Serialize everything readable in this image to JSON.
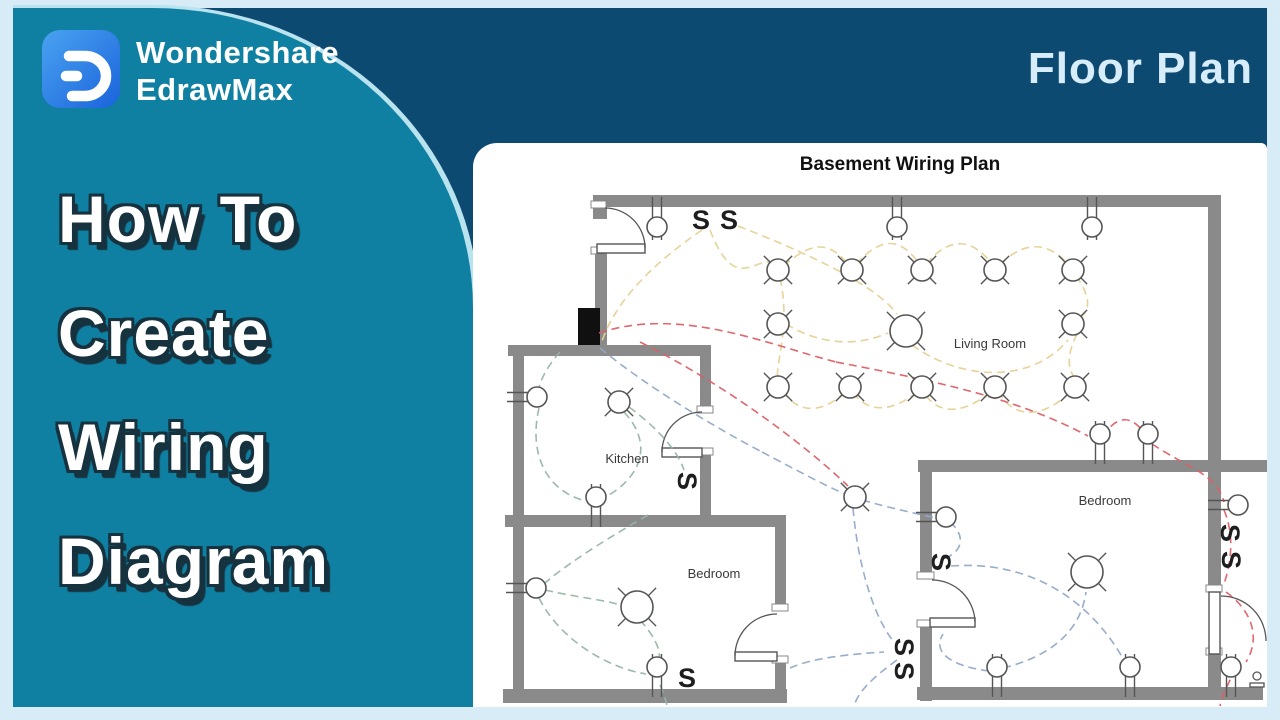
{
  "brand": {
    "line1": "Wondershare",
    "line2": "EdrawMax"
  },
  "badge": "Floor Plan",
  "headline": {
    "lines": [
      "How To",
      "Create",
      "Wiring",
      "Diagram"
    ]
  },
  "colors": {
    "frame": "#d7ecf7",
    "navy": "#0d4a72",
    "teal": "#1080a2",
    "badge_text": "#d7edfa",
    "headline_fill": "#ffffff",
    "headline_outline": "#16323f",
    "logo_from": "#4aa3f0",
    "logo_to": "#1a63dc"
  },
  "plan": {
    "title": "Basement Wiring Plan",
    "switch_letter": "S",
    "labels": [
      {
        "text": "Living Room",
        "x": 990,
        "y": 348
      },
      {
        "text": "Kitchen",
        "x": 627,
        "y": 463
      },
      {
        "text": "Bedroom",
        "x": 714,
        "y": 578
      },
      {
        "text": "Bedroom",
        "x": 1105,
        "y": 505
      }
    ],
    "walls": [
      [
        593,
        195,
        627,
        12
      ],
      [
        593,
        195,
        14,
        24
      ],
      [
        1208,
        195,
        13,
        271
      ],
      [
        595,
        252,
        12,
        96
      ],
      [
        508,
        345,
        203,
        11
      ],
      [
        513,
        345,
        11,
        170
      ],
      [
        700,
        345,
        11,
        67
      ],
      [
        700,
        454,
        11,
        62
      ],
      [
        505,
        515,
        281,
        12
      ],
      [
        513,
        515,
        11,
        186
      ],
      [
        503,
        689,
        284,
        14
      ],
      [
        775,
        515,
        11,
        95
      ],
      [
        775,
        662,
        11,
        41
      ],
      [
        918,
        460,
        297,
        12
      ],
      [
        920,
        460,
        12,
        118
      ],
      [
        920,
        626,
        12,
        75
      ],
      [
        917,
        687,
        346,
        13
      ],
      [
        1208,
        460,
        13,
        130
      ],
      [
        1208,
        654,
        13,
        46
      ],
      [
        1221,
        460,
        46,
        12
      ]
    ],
    "electrical_panel": [
      578,
      308,
      22,
      37
    ],
    "jambs": [
      [
        591,
        201,
        15,
        7
      ],
      [
        591,
        247,
        15,
        7
      ],
      [
        697,
        406,
        16,
        7
      ],
      [
        697,
        448,
        16,
        7
      ],
      [
        772,
        604,
        16,
        7
      ],
      [
        772,
        656,
        16,
        7
      ],
      [
        917,
        572,
        17,
        7
      ],
      [
        917,
        620,
        17,
        7
      ],
      [
        1206,
        585,
        16,
        7
      ],
      [
        1206,
        648,
        16,
        7
      ]
    ],
    "door_leaves": [
      [
        597,
        244,
        48,
        9
      ],
      [
        662,
        448,
        40,
        9
      ],
      [
        735,
        652,
        42,
        9
      ],
      [
        930,
        618,
        45,
        9
      ],
      [
        1209,
        592,
        11,
        62
      ]
    ],
    "door_arcs": [
      "M 645 248 A 40 40 0 0 0 605 208",
      "M 662 452 A 40 40 0 0 1 702 412",
      "M 735 656 A 42 42 0 0 1 777 614",
      "M 975 622 A 43 43 0 0 0 932 580",
      "M 1221 596 A 45 45 0 0 1 1266 641"
    ],
    "lights_small": [
      [
        778,
        270
      ],
      [
        852,
        270
      ],
      [
        922,
        270
      ],
      [
        995,
        270
      ],
      [
        1073,
        270
      ],
      [
        778,
        324
      ],
      [
        1073,
        324
      ],
      [
        778,
        387
      ],
      [
        850,
        387
      ],
      [
        922,
        387
      ],
      [
        995,
        387
      ],
      [
        1075,
        387
      ],
      [
        855,
        497
      ],
      [
        619,
        402
      ]
    ],
    "lights_large": [
      [
        906,
        331
      ],
      [
        637,
        607
      ],
      [
        1087,
        572
      ]
    ],
    "fixtures_below_wall": [
      [
        657,
        227
      ],
      [
        897,
        227
      ],
      [
        1092,
        227
      ]
    ],
    "fixtures_above_wall": [
      [
        596,
        497
      ],
      [
        657,
        667
      ],
      [
        997,
        667
      ],
      [
        1130,
        667
      ],
      [
        1231,
        667
      ],
      [
        1100,
        434
      ],
      [
        1148,
        434
      ]
    ],
    "sconces": [
      [
        537,
        397
      ],
      [
        536,
        588
      ],
      [
        946,
        517
      ],
      [
        1238,
        505
      ]
    ],
    "switches": [
      {
        "x": 701,
        "y": 220,
        "r": 0
      },
      {
        "x": 729,
        "y": 220,
        "r": 0
      },
      {
        "x": 687,
        "y": 481,
        "r": 90
      },
      {
        "x": 687,
        "y": 678,
        "r": 0
      },
      {
        "x": 904,
        "y": 647,
        "r": 90
      },
      {
        "x": 904,
        "y": 671,
        "r": 90
      },
      {
        "x": 941,
        "y": 562,
        "r": 90
      },
      {
        "x": 1230,
        "y": 533,
        "r": 90
      },
      {
        "x": 1231,
        "y": 560,
        "r": 90
      }
    ],
    "doorbell": {
      "x": 1257,
      "y": 676
    },
    "wires": {
      "lighting": [
        "M 702 230 C 655 262 615 300 601 344",
        "M 710 230 C 736 298 758 252 775 264",
        "M 780 278 C 792 330 772 372 779 380",
        "M 784 266 C 812 240 830 242 848 264",
        "M 856 264 C 882 236 900 238 918 262",
        "M 926 264 C 950 236 972 238 992 264",
        "M 1000 264 C 1026 240 1048 242 1068 264",
        "M 1076 276 C 1092 298 1090 312 1079 318",
        "M 1077 334 C 1066 356 1068 370 1075 378",
        "M 1070 392 C 1042 420 1012 418 999 392",
        "M 990 392 C 962 416 936 414 924 392",
        "M 917 392 C 890 414 866 412 853 392",
        "M 845 392 C 820 416 796 412 783 391",
        "M 786 324 C 822 346 858 346 888 333",
        "M 738 226 C 820 258 878 288 897 314",
        "M 912 345 C 960 380 1030 385 1068 340"
      ],
      "power": [
        "M 599 333 C 680 306 766 344 836 362",
        "M 836 362 C 940 382 1016 398 1088 436",
        "M 1103 437 C 1116 414 1134 414 1146 437",
        "M 1152 444 C 1192 470 1216 474 1224 502",
        "M 1224 510 C 1234 534 1232 560 1224 584",
        "M 1226 592 C 1254 612 1260 640 1246 662",
        "M 1236 668 C 1228 684 1222 696 1220 706",
        "M 640 342 C 720 382 800 440 848 486"
      ],
      "branch_blue": [
        "M 600 348 C 648 388 720 430 762 452",
        "M 762 452 C 800 472 826 486 845 494",
        "M 862 500 C 890 508 914 513 936 518",
        "M 950 522 C 966 536 962 550 948 557",
        "M 951 566 C 1030 560 1092 600 1126 664",
        "M 989 671 C 950 666 932 652 943 634",
        "M 1003 668 C 1044 658 1080 636 1086 592",
        "M 853 508 C 858 566 874 618 894 642",
        "M 897 660 C 872 678 858 692 854 706",
        "M 790 668 C 812 658 850 654 884 652"
      ],
      "branch_green": [
        "M 560 352 C 546 368 539 382 538 394",
        "M 539 408 C 528 456 548 492 586 501",
        "M 624 412 C 654 444 642 478 602 499",
        "M 629 407 C 660 430 678 452 684 470",
        "M 648 515 C 596 545 562 568 545 583",
        "M 539 598 C 560 640 608 668 646 674",
        "M 545 590 C 580 598 606 600 620 605",
        "M 640 620 C 658 640 662 654 658 664",
        "M 660 685 C 664 694 666 700 667 706"
      ]
    },
    "colors": {
      "wall": "#8a8a8a",
      "symbol": "#555555",
      "label": "#3a3a3a",
      "title": "#111111",
      "switch": "#1e1e1e",
      "wire_lighting": "#e6d092",
      "wire_power": "#dd5f65",
      "wire_blue": "#92a9c8",
      "wire_green": "#97b5a4"
    }
  }
}
